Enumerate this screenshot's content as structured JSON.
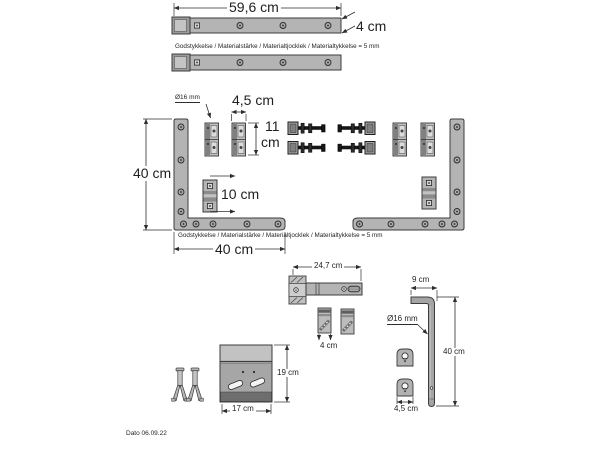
{
  "sheet": {
    "thickness_note": "Godstykkelse / Materialstärke / Materialtjocklek / Materialtykkelse = 5 mm",
    "date": "Dato 06.09.22"
  },
  "top_bars": {
    "length_label": "59,6 cm",
    "width_label": "4 cm"
  },
  "frame": {
    "clamp_diameter_label": "Ø16 mm",
    "clamp_width_label": "4,5 cm",
    "clamp_height_value": "11",
    "clamp_height_unit": "cm",
    "height_label": "40 cm",
    "spacer_length_label": "10 cm",
    "width_label": "40 cm"
  },
  "latch": {
    "length_label": "24,7 cm",
    "clip_width_label": "4 cm"
  },
  "rod": {
    "top_length_label": "9 cm",
    "diameter_label": "Ø16 mm",
    "length_label": "40 cm",
    "keyhole_plate_width_label": "4,5 cm"
  },
  "plate": {
    "height_label": "19 cm",
    "width_label": "17 cm"
  },
  "colors": {
    "part_gray": "#b4b4b4",
    "part_dark": "#6e6e6e",
    "bolt_black": "#161616",
    "line": "#2e2e2e",
    "background": "#ffffff"
  }
}
